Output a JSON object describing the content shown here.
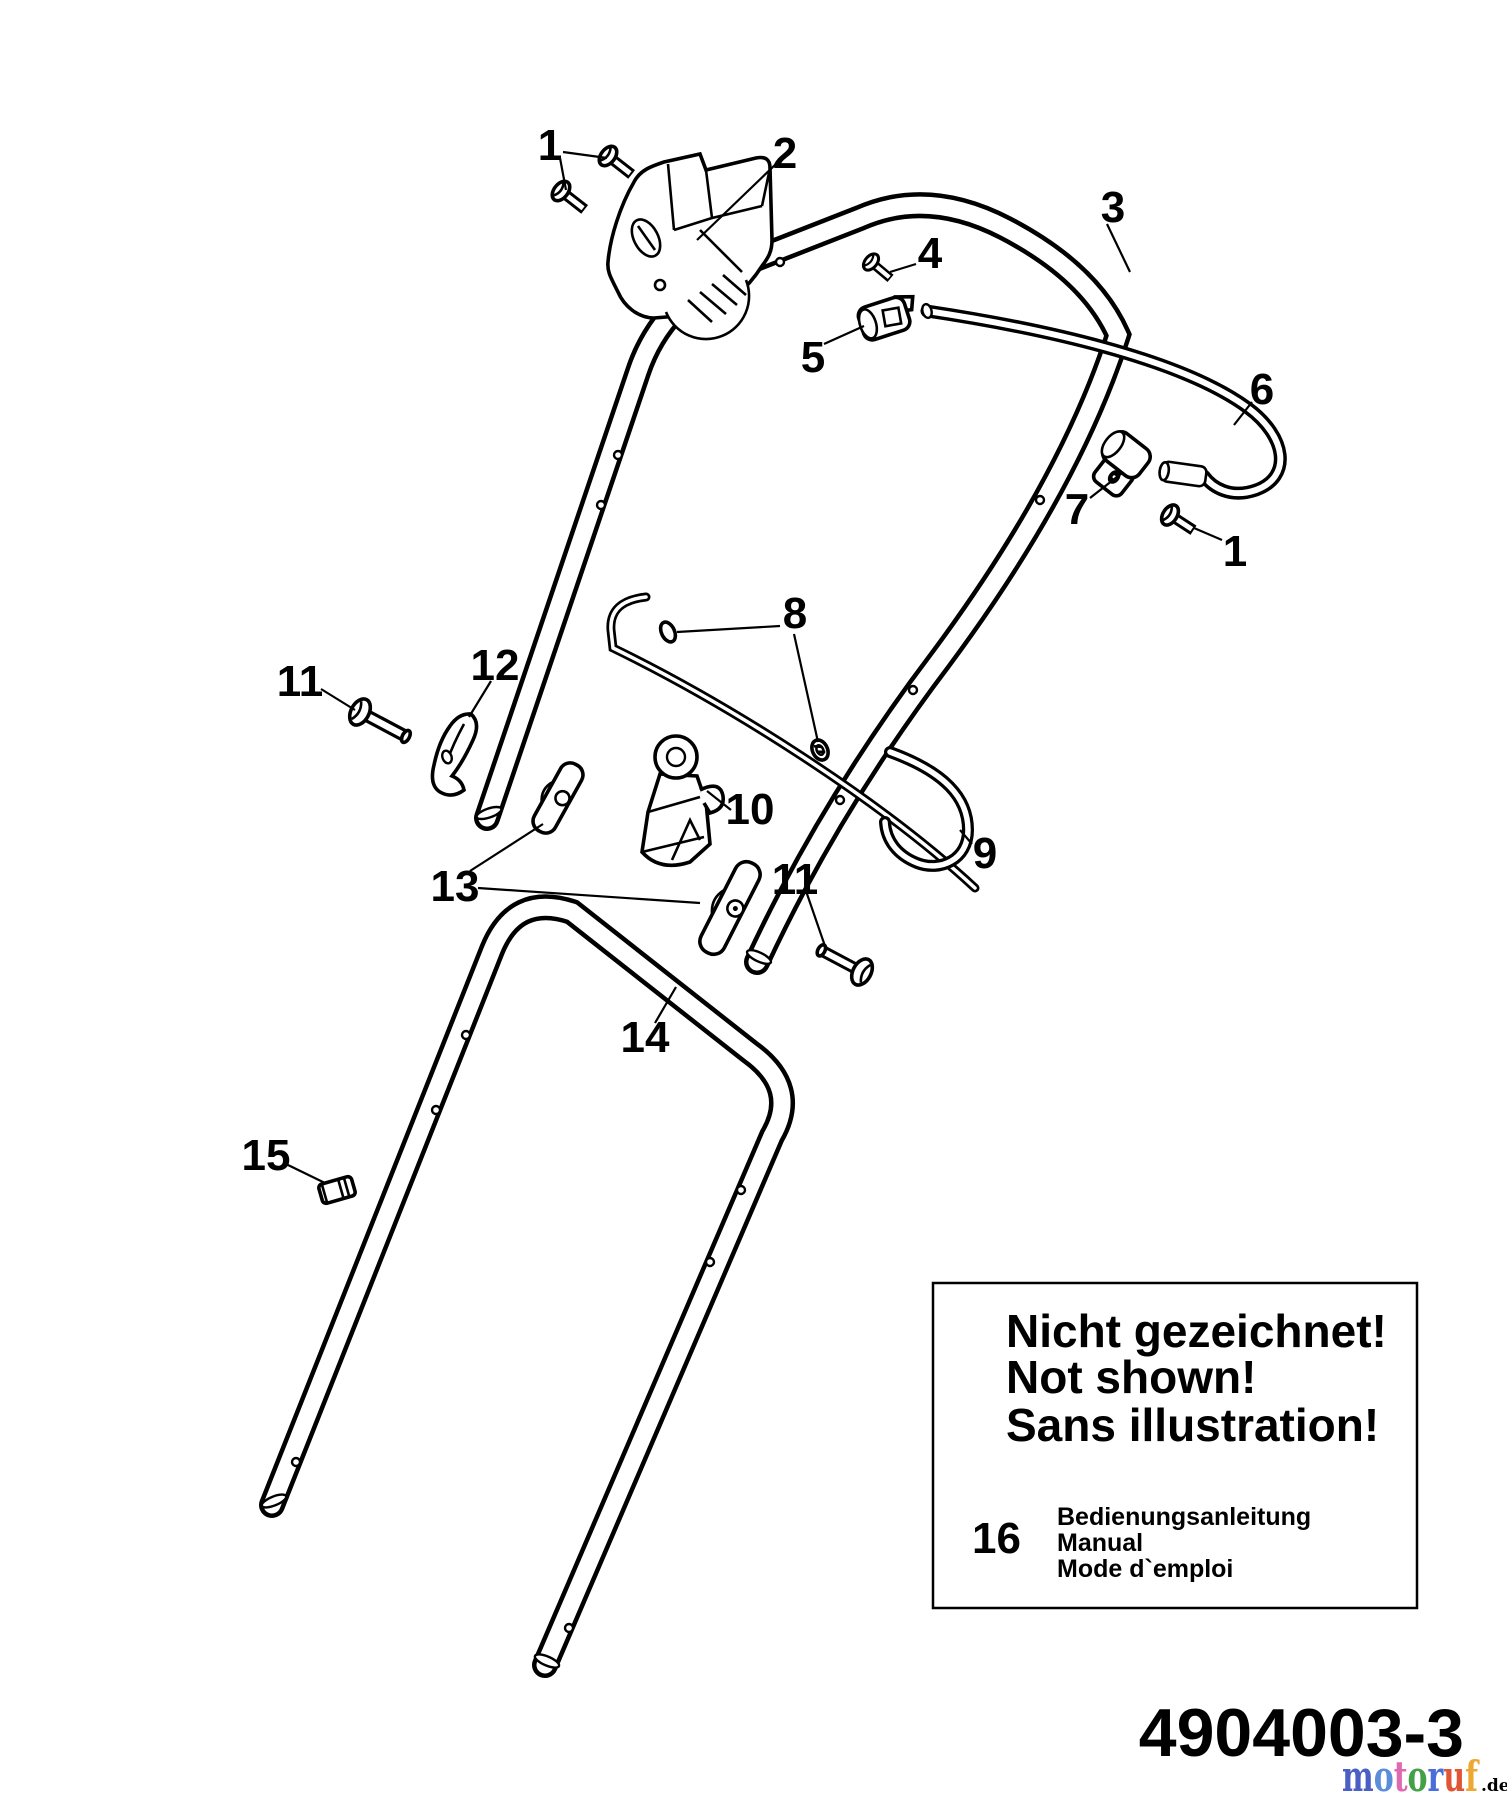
{
  "page": {
    "background": "#ffffff",
    "line_color": "#000000"
  },
  "callouts": {
    "screws_top": "1",
    "switch_housing": "2",
    "upper_handle": "3",
    "clamp_bolt": "4",
    "cable_clamp_upper": "5",
    "cable": "6",
    "cable_clamp_lower": "7",
    "screw_right": "1",
    "rod_rings": "8",
    "wire_loop": "9",
    "cable_guide": "10",
    "bolt_left": "11",
    "hook_lever": "12",
    "wing_knobs": "13",
    "lower_handle": "14",
    "bolt_right": "11",
    "sleeve": "15"
  },
  "not_shown_box": {
    "line_de": "Nicht gezeichnet!",
    "line_en": "Not shown!",
    "line_fr": "Sans illustration!",
    "item_number": "16",
    "item_de": "Bedienungsanleitung",
    "item_en": "Manual",
    "item_fr": "Mode d`emploi"
  },
  "footer": {
    "part_number": "4904003-3"
  },
  "watermark": {
    "letters": [
      {
        "ch": "m",
        "color": "#4a5ec4"
      },
      {
        "ch": "o",
        "color": "#5b8dd9"
      },
      {
        "ch": "t",
        "color": "#e06ab0"
      },
      {
        "ch": "o",
        "color": "#43a047"
      },
      {
        "ch": "r",
        "color": "#4a6ed9"
      },
      {
        "ch": "u",
        "color": "#e05536"
      },
      {
        "ch": "f",
        "color": "#eda833"
      }
    ],
    "suffix": ".de",
    "suffix_color": "#8a8a8a"
  }
}
